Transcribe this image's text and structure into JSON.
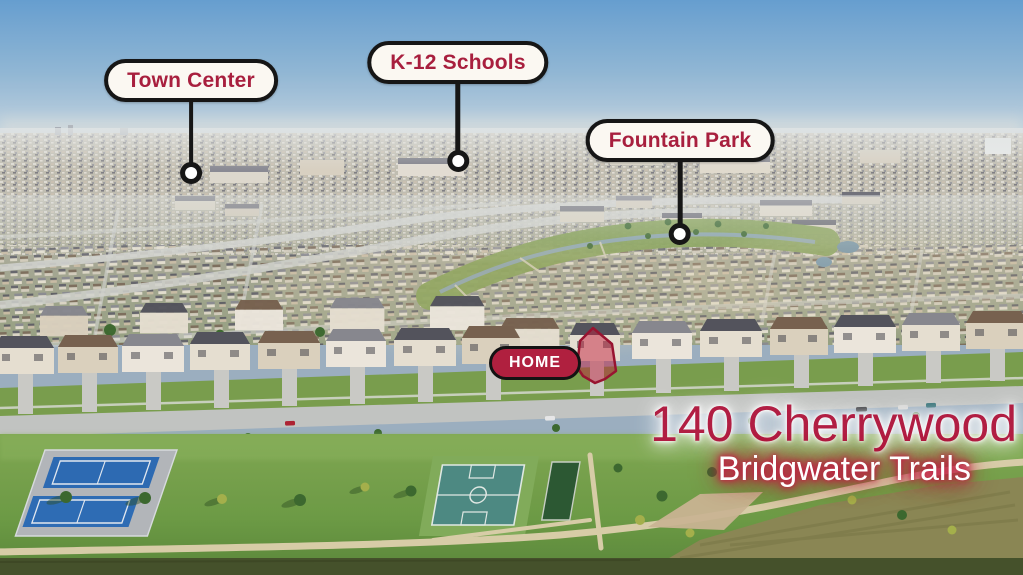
{
  "callouts": [
    {
      "id": "town-center",
      "label": "Town Center"
    },
    {
      "id": "k12-schools",
      "label": "K-12 Schools"
    },
    {
      "id": "fountain-park",
      "label": "Fountain Park"
    }
  ],
  "home_marker": {
    "label": "HOME"
  },
  "address": {
    "street": "140 Cherrywood",
    "community": "Bridgwater Trails"
  },
  "colors": {
    "callout_text": "#a81f3e",
    "callout_bg": "#fbf8f2",
    "callout_border": "#161616",
    "home_badge_bg": "#b0203f",
    "home_badge_text": "#ffffff",
    "address_primary": "#b11e43",
    "address_secondary_text": "#ffffff",
    "address_secondary_glow": "#c21f45",
    "lot_highlight": "#c81e3c",
    "sky": "#69a3d4",
    "park_green": "#6f9e46",
    "tennis_court_blue": "#2e6db6",
    "basketball_court_teal": "#4f8d85"
  }
}
